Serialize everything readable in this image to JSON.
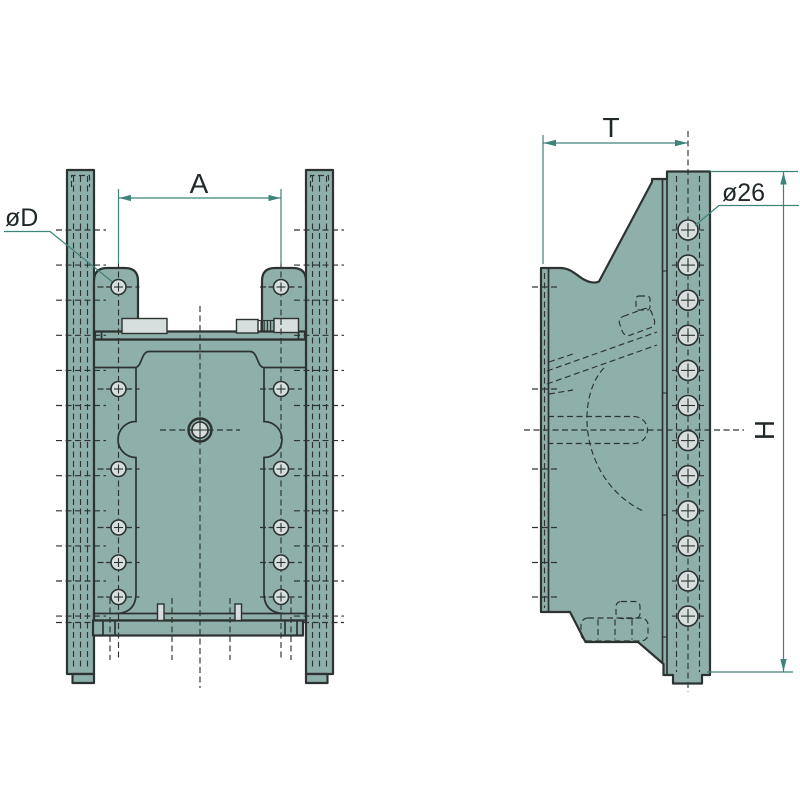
{
  "drawing": {
    "labels": {
      "dim_a": "A",
      "dim_d": "øD",
      "dim_t": "T",
      "dim_hole": "ø26",
      "dim_h": "H"
    },
    "colors": {
      "background": "#ffffff",
      "body_fill": "#8fafab",
      "light_fill": "#d6dfdd",
      "outline": "#2c3330",
      "dimension_line": "#3f837a",
      "label_text": "#20282a"
    },
    "front_view": {
      "plate_hole_columns_x": [
        118.5,
        281
      ],
      "plate_hole_rows_y": [
        287,
        389,
        469,
        527.5,
        562.5,
        597
      ],
      "plate_hole_radius": 7.5,
      "rail_row_ys": [
        230,
        265.1,
        300.2,
        335.3,
        370.4,
        405.5,
        440.6,
        475.7,
        510.8,
        545.9,
        581,
        616.1
      ],
      "center_hole": {
        "x": 200,
        "y": 430,
        "outer_radius": 11.5,
        "inner_radius": 8
      }
    },
    "side_view": {
      "hole_column_x": 688,
      "hole_first_y": 230,
      "hole_pitch": 35.1,
      "hole_count": 12,
      "hole_radius": 10,
      "band_stub_ys": [
        287,
        389,
        469,
        527.5,
        562.5,
        597
      ]
    }
  }
}
